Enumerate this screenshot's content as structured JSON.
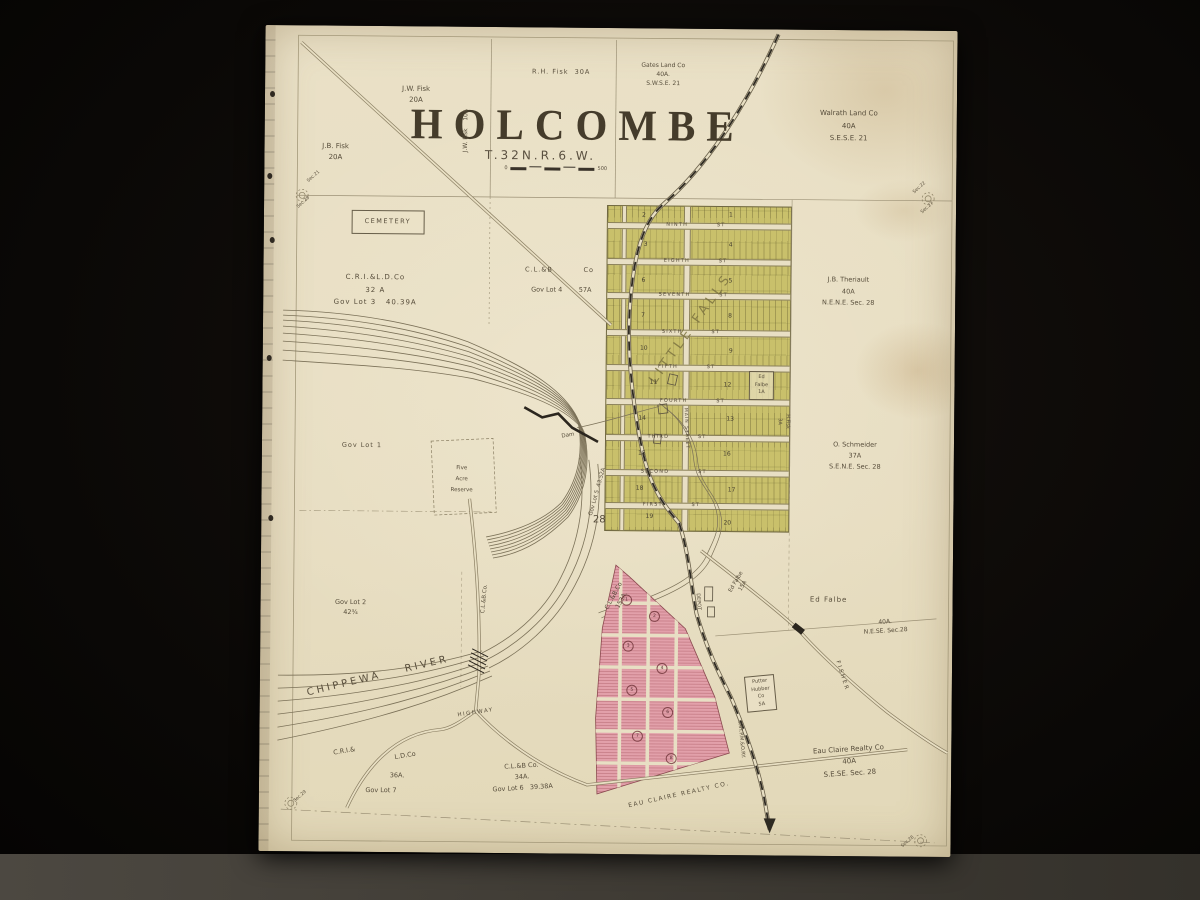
{
  "scene": {
    "colors": {
      "background": "#0b0908",
      "shelf": "#46423b",
      "paper": "#e9e0c6",
      "ink": "#564c3a",
      "title_ink": "#453c2b",
      "plat_yellow": "#c9c06b",
      "plat_pink": "#e2a0aa",
      "railroad": "#2e2a22",
      "water": "#7b7158"
    }
  },
  "map": {
    "title": "HOLCOMBE",
    "subtitle": "T.32N.R.6.W.",
    "scale": {
      "left": "0",
      "right": "500"
    },
    "labels": [
      {
        "name": "jw-fisk-20a",
        "text": "J.W. Fisk\n20A",
        "x": 151,
        "y": 68,
        "fs": 7
      },
      {
        "name": "jb-fisk-20a",
        "text": "J.B. Fisk\n20A",
        "x": 71,
        "y": 126,
        "fs": 7
      },
      {
        "name": "jw-fisk-10a",
        "text": "J.W. Fisk    10A",
        "x": 201,
        "y": 104,
        "rot": -90,
        "fs": 6
      },
      {
        "name": "rh-fisk-30a",
        "text": "R.H. Fisk  30A",
        "x": 296,
        "y": 45,
        "fs": 6.5,
        "ls": 1
      },
      {
        "name": "gates-land-co",
        "text": "Gates Land Co\n40A.\nS.W.S.E. 21",
        "x": 398,
        "y": 46,
        "fs": 6
      },
      {
        "name": "walrath-land-co",
        "text": "Walrath Land Co\n40A\nS.E.S.E. 21",
        "x": 584,
        "y": 96,
        "fs": 7,
        "lh": 1.8
      },
      {
        "name": "cemetery",
        "text": "CEMETERY",
        "x": 124,
        "y": 196,
        "fs": 6.5,
        "ls": 1.5,
        "box": 1,
        "pad": "6px 12px"
      },
      {
        "name": "cril-d-co",
        "text": "C.R.I.&L.D.Co\n32 A\nGov Lot 3   40.39A",
        "x": 112,
        "y": 264,
        "fs": 7,
        "lh": 1.8,
        "ls": 1
      },
      {
        "name": "clb-co-lot4-a",
        "text": "C.L.&B          Co",
        "x": 296,
        "y": 243,
        "fs": 6.5,
        "ls": 1
      },
      {
        "name": "clb-co-lot4-b",
        "text": "Gov Lot 4        57A",
        "x": 298,
        "y": 263,
        "fs": 6.5
      },
      {
        "name": "jb-theriault",
        "text": "J.B. Theriault\n40A\nN.E.N.E. Sec. 28",
        "x": 585,
        "y": 262,
        "fs": 6.5,
        "lh": 1.8
      },
      {
        "name": "o-schmeider",
        "text": "O. Schmeider\n37A\nS.E.N.E. Sec. 28",
        "x": 593,
        "y": 426,
        "fs": 6.5,
        "lh": 1.7
      },
      {
        "name": "ed-falbe-1a",
        "text": "Ed\nFalbe\n1A",
        "x": 499,
        "y": 356,
        "fs": 5,
        "box": 1,
        "pad": "2px 5px"
      },
      {
        "name": "h-fisk-3a",
        "text": "H.Fisk\n3A",
        "x": 521,
        "y": 392,
        "rot": 90,
        "fs": 5
      },
      {
        "name": "gov-lot-1",
        "text": "Gov Lot 1",
        "x": 100,
        "y": 420,
        "fs": 6.5,
        "ls": 1
      },
      {
        "name": "five-acre-reserve",
        "text": "Five\nAcre\nReserve",
        "x": 200,
        "y": 453,
        "fs": 5.5,
        "lh": 2
      },
      {
        "name": "dam",
        "text": "Dam",
        "x": 306,
        "y": 408,
        "rot": -10,
        "fs": 5.5
      },
      {
        "name": "gov-lot-5",
        "text": "Gov Lot 5  43.52A",
        "x": 336,
        "y": 464,
        "rot": -75,
        "fs": 5.5
      },
      {
        "name": "section-number-28",
        "text": "28",
        "x": 338,
        "y": 492,
        "fs": 10
      },
      {
        "name": "gov-lot-2",
        "text": "Gov Lot 2\n42¾",
        "x": 90,
        "y": 582,
        "fs": 6.5
      },
      {
        "name": "clb-co-road",
        "text": "C.L.&B.Co.",
        "x": 224,
        "y": 572,
        "rot": -85,
        "fs": 5.5
      },
      {
        "name": "chippewa-river",
        "text": "CHIPPEWA    RIVER",
        "x": 118,
        "y": 650,
        "rot": -14,
        "fs": 10,
        "ls": 3
      },
      {
        "name": "highway",
        "text": "HIGHWAY",
        "x": 216,
        "y": 686,
        "rot": -9,
        "fs": 5.5,
        "ls": 1.5
      },
      {
        "name": "clb-co-153a",
        "text": "C.L.&B.Co\n153A.",
        "x": 357,
        "y": 570,
        "rot": -62,
        "fs": 6
      },
      {
        "name": "depot",
        "text": "DEPOT",
        "x": 437,
        "y": 573,
        "rot": 85,
        "fs": 5
      },
      {
        "name": "ed-falbe-15a",
        "text": "Ed Falbe\n15A",
        "x": 479,
        "y": 555,
        "rot": -60,
        "fs": 5.5
      },
      {
        "name": "ed-falbe-40a-name",
        "text": "Ed Falbe",
        "x": 568,
        "y": 570,
        "fs": 7,
        "ls": 1
      },
      {
        "name": "ed-falbe-40a-desc",
        "text": "40A.\nN.E.SE. Sec.28",
        "x": 625,
        "y": 596,
        "rot": -4,
        "fs": 6
      },
      {
        "name": "fisher-road",
        "text": "FISHER",
        "x": 582,
        "y": 646,
        "rot": 72,
        "fs": 5.5,
        "ls": 2
      },
      {
        "name": "putter-hubber-co",
        "text": "Putter\nHubber\nCo\n5A",
        "x": 501,
        "y": 664,
        "fs": 5,
        "box": 1,
        "pad": "2px 5px",
        "rot": -6
      },
      {
        "name": "eau-claire-realty-plat",
        "text": "EAU CLAIRE REALTY CO.",
        "x": 420,
        "y": 766,
        "rot": -13,
        "fs": 6,
        "ls": 1.5
      },
      {
        "name": "eau-claire-realty-40a",
        "text": "Eau Claire Realty Co\n40A\nS.E.SE. Sec. 28",
        "x": 590,
        "y": 732,
        "rot": -4,
        "fs": 7,
        "lh": 1.7
      },
      {
        "name": "cstpmo-railway",
        "text": "C.ST.P.M.&O.RY.",
        "x": 481,
        "y": 710,
        "rot": 84,
        "fs": 5
      },
      {
        "name": "cri-ld-co-1",
        "text": "C.R.I.&",
        "x": 85,
        "y": 726,
        "rot": -10,
        "fs": 6.5
      },
      {
        "name": "cri-ld-co-2",
        "text": "L.D.Co",
        "x": 146,
        "y": 730,
        "rot": -10,
        "fs": 6.5
      },
      {
        "name": "cri-ld-co-3",
        "text": "36A.",
        "x": 138,
        "y": 750,
        "fs": 6.5
      },
      {
        "name": "cri-ld-co-4",
        "text": "Gov Lot 7",
        "x": 122,
        "y": 765,
        "fs": 6.5
      },
      {
        "name": "clb-co-34a",
        "text": "C.L.&B Co.\n34A.\nGov Lot 6   39.38A",
        "x": 263,
        "y": 750,
        "rot": -4,
        "fs": 6.5,
        "lh": 1.7
      },
      {
        "name": "little-falls",
        "text": "LITTLE FALLS",
        "x": 428,
        "y": 300,
        "rot": -55,
        "fs": 13,
        "ls": 4,
        "col": "#7d7440",
        "op": 0.85
      },
      {
        "name": "main-street",
        "text": "MAIN STREET",
        "x": 423,
        "y": 400,
        "rot": 87,
        "fs": 4.5,
        "ls": 1
      },
      {
        "name": "street-ninth",
        "text": "NINTH ST",
        "x": 432,
        "y": 197,
        "fs": 5,
        "ls": 1.2,
        "ws": 26
      },
      {
        "name": "street-eighth",
        "text": "EIGHTH ST",
        "x": 432,
        "y": 233,
        "fs": 5,
        "ls": 1.2,
        "ws": 26
      },
      {
        "name": "street-seventh",
        "text": "SEVENTH ST",
        "x": 430,
        "y": 267,
        "fs": 5,
        "ls": 1.2,
        "ws": 26
      },
      {
        "name": "street-sixth",
        "text": "SIXTH ST",
        "x": 428,
        "y": 304,
        "fs": 5,
        "ls": 1.2,
        "ws": 26
      },
      {
        "name": "street-fifth",
        "text": "FIFTH ST",
        "x": 424,
        "y": 339,
        "fs": 5,
        "ls": 1.2,
        "ws": 26
      },
      {
        "name": "street-fourth",
        "text": "FOURTH ST",
        "x": 430,
        "y": 373,
        "fs": 5,
        "ls": 1.2,
        "ws": 26
      },
      {
        "name": "street-third",
        "text": "THIRD ST",
        "x": 415,
        "y": 409,
        "fs": 5,
        "ls": 1.2,
        "ws": 26
      },
      {
        "name": "street-second",
        "text": "SECOND ST",
        "x": 412,
        "y": 444,
        "fs": 5,
        "ls": 1.2,
        "ws": 26
      },
      {
        "name": "street-first",
        "text": "FIRST ST",
        "x": 410,
        "y": 477,
        "fs": 5,
        "ls": 1.2,
        "ws": 26
      },
      {
        "name": "sec-21-nw",
        "text": "Sec.21",
        "x": 50,
        "y": 152,
        "rot": -42,
        "fs": 4.5
      },
      {
        "name": "sec-28-nw",
        "text": "Sec.28",
        "x": 40,
        "y": 178,
        "rot": -42,
        "fs": 4.5
      },
      {
        "name": "sec-22-ne",
        "text": "Sec.22",
        "x": 656,
        "y": 158,
        "rot": -42,
        "fs": 4.5
      },
      {
        "name": "sec-27-ne",
        "text": "Sec.27",
        "x": 664,
        "y": 178,
        "rot": -42,
        "fs": 4.5
      },
      {
        "name": "sec-29-sw",
        "text": "Sec.29",
        "x": 42,
        "y": 772,
        "rot": -42,
        "fs": 4.5
      },
      {
        "name": "sec-28-se",
        "text": "Sec.28",
        "x": 650,
        "y": 812,
        "rot": -42,
        "fs": 4.5
      }
    ],
    "yellow_blocks": [
      {
        "n": "2",
        "x": 380,
        "y": 187
      },
      {
        "n": "1",
        "x": 467,
        "y": 186
      },
      {
        "n": "3",
        "x": 382,
        "y": 216
      },
      {
        "n": "4",
        "x": 467,
        "y": 216
      },
      {
        "n": "6",
        "x": 380,
        "y": 252
      },
      {
        "n": "5",
        "x": 467,
        "y": 252
      },
      {
        "n": "7",
        "x": 380,
        "y": 287
      },
      {
        "n": "8",
        "x": 467,
        "y": 287
      },
      {
        "n": "10",
        "x": 381,
        "y": 320
      },
      {
        "n": "9",
        "x": 468,
        "y": 322
      },
      {
        "n": "11",
        "x": 391,
        "y": 354
      },
      {
        "n": "12",
        "x": 465,
        "y": 356
      },
      {
        "n": "14",
        "x": 380,
        "y": 390
      },
      {
        "n": "13",
        "x": 468,
        "y": 390
      },
      {
        "n": "15",
        "x": 380,
        "y": 425
      },
      {
        "n": "16",
        "x": 465,
        "y": 425
      },
      {
        "n": "18",
        "x": 378,
        "y": 460
      },
      {
        "n": "17",
        "x": 470,
        "y": 461
      },
      {
        "n": "19",
        "x": 388,
        "y": 488
      },
      {
        "n": "20",
        "x": 466,
        "y": 494
      }
    ],
    "pink_blocks": [
      {
        "n": "1",
        "x": 366,
        "y": 572
      },
      {
        "n": "2",
        "x": 394,
        "y": 588
      },
      {
        "n": "3",
        "x": 368,
        "y": 618
      },
      {
        "n": "4",
        "x": 402,
        "y": 640
      },
      {
        "n": "5",
        "x": 372,
        "y": 662
      },
      {
        "n": "6",
        "x": 408,
        "y": 684
      },
      {
        "n": "7",
        "x": 378,
        "y": 708
      },
      {
        "n": "8",
        "x": 412,
        "y": 730
      }
    ]
  }
}
